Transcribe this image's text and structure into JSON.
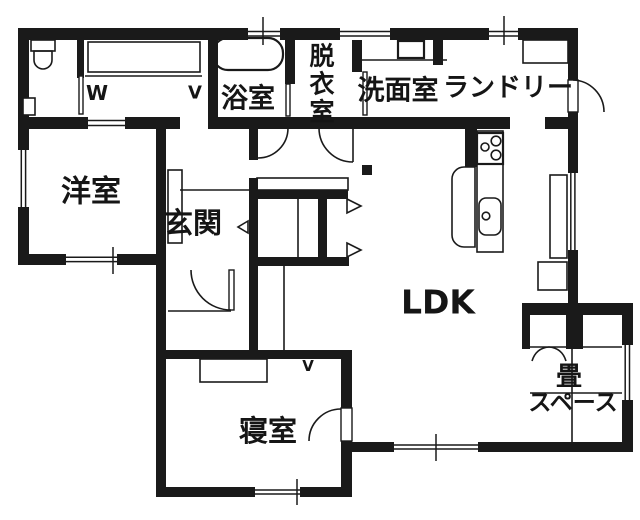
{
  "plan": {
    "type": "floorplan",
    "colors": {
      "wall": "#1a1a1a",
      "background": "#ffffff",
      "line": "#1a1a1a"
    },
    "rooms": {
      "western_room": {
        "label": "洋室"
      },
      "entrance": {
        "label": "玄関"
      },
      "bathroom": {
        "label": "浴室"
      },
      "dressing_room": {
        "label": "脱衣室",
        "chars": [
          "脱",
          "衣",
          "室"
        ]
      },
      "washroom": {
        "label": "洗面室"
      },
      "laundry": {
        "label": "ランドリー"
      },
      "ldk": {
        "label": "LDK"
      },
      "bedroom": {
        "label": "寝室"
      },
      "tatami_space": {
        "label": "畳スペース",
        "line1": "畳",
        "line2": "スペース"
      }
    },
    "marks": {
      "closet_hanger_left": "W",
      "closet_hanger_right": "V",
      "bedroom_hanger": "V"
    },
    "fixtures": [
      "toilet",
      "toilet-paper-holder",
      "closet-shelf",
      "hanger-pipe",
      "bathtub",
      "vanity-sink",
      "washing-machine",
      "shoe-cabinet",
      "gas-stove",
      "kitchen-counter",
      "kitchen-sink",
      "kitchen-island",
      "cupboard",
      "pillar",
      "tatami-mats",
      "storage",
      "entry-markers"
    ]
  }
}
